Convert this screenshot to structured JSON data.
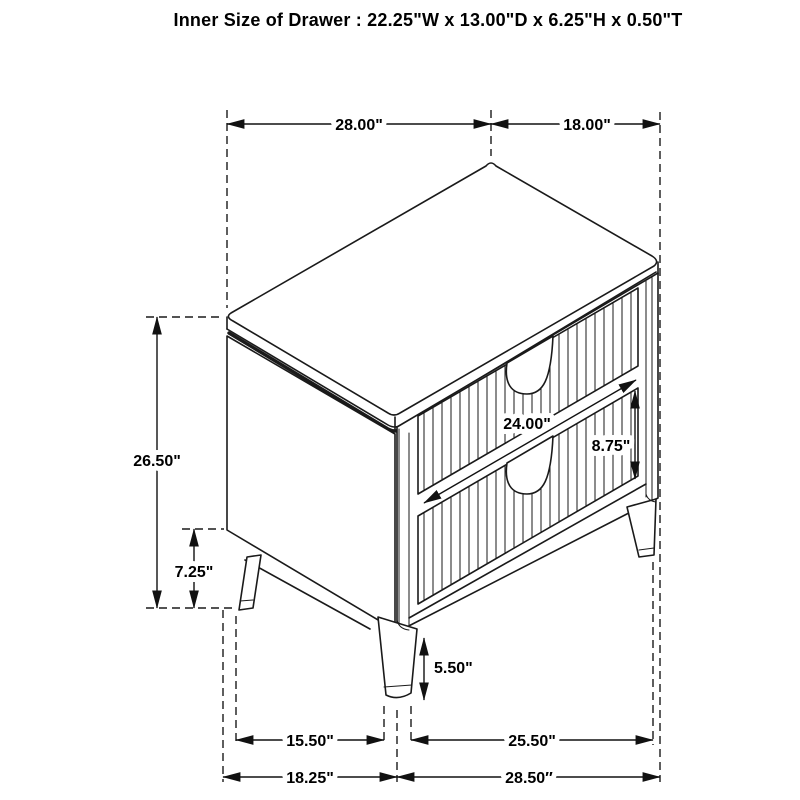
{
  "title": "Inner Size of Drawer : 22.25\"W x 13.00\"D x 6.25\"H x 0.50\"T",
  "dims": {
    "top_width": "28.00\"",
    "top_depth": "18.00\"",
    "overall_height": "26.50\"",
    "base_gap_height": "7.25\"",
    "drawer_width": "24.00\"",
    "bottom_drawer_height": "8.75\"",
    "leg_height": "5.50\"",
    "front_leg_span": "15.50\"",
    "side_leg_span": "25.50\"",
    "base_front_width": "18.25\"",
    "base_side_depth": "28.50″"
  }
}
